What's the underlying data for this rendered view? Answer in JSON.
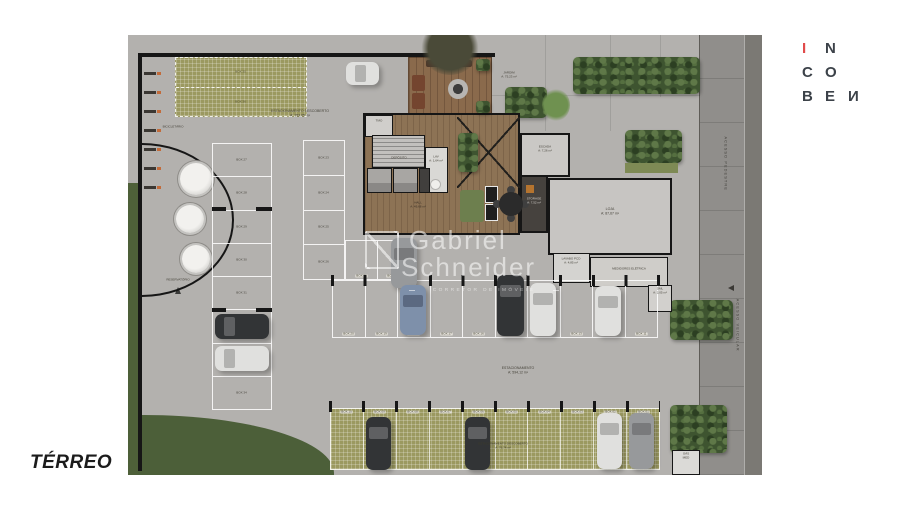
{
  "title": {
    "floor": "TÉRREO"
  },
  "logo": {
    "l1a": "I",
    "l1b": "N",
    "l2a": "C",
    "l2b": "O",
    "l3a": "B",
    "l3b": "E",
    "l3c": "И"
  },
  "watermark": {
    "first": "Gabriel",
    "last": "Schneider",
    "tagline": "CORRETOR DE IMÓVEIS"
  },
  "areas": {
    "bicicletario": "BICICLETÁRIO",
    "estac_desc_top": {
      "name": "ESTACIONAMENTO DESCOBERTO",
      "area": "A: 153,05 m²"
    },
    "reservatorio": "RESERVATÓRIO",
    "jardim": {
      "name": "JARDIM",
      "area": "A: 75,23 m²"
    },
    "tmo": "TMO",
    "deposito": "DEPÓSITO",
    "lav": {
      "name": "LAV",
      "area": "A: 1,64 m²"
    },
    "hall": {
      "name": "HALL",
      "area": "A: 49,68 m²"
    },
    "escada": {
      "name": "ESCADA",
      "area": "A: 7,26 m²"
    },
    "storage": {
      "name": "STORAGE",
      "area": "A: 7,52 m²"
    },
    "loja": {
      "name": "LOJA",
      "area": "A: 87,67 m²"
    },
    "lavabo": {
      "name": "LAVABO PCD",
      "area": "A: 4,85 m²"
    },
    "medidores": "MEDIDORES ELÉTRICA",
    "dml": {
      "name": "DML",
      "area": "A: 2,05 m²"
    },
    "gas": {
      "name": "GÁS",
      "sub": "MED"
    },
    "estacionamento": {
      "name": "ESTACIONAMENTO",
      "area": "A: 594,12 m²"
    },
    "estac_desc_bottom": {
      "name": "ESTACIONAMENTO DESCOBERTO",
      "area": "A: 76,74 m²"
    },
    "acesso_pedestre": "ACESSO PEDESTRE",
    "acesso_veicular": "ACESSO VEICULAR"
  },
  "parking": {
    "grass_boxes": [
      "BOX 35",
      "BOX 36"
    ],
    "left_column": [
      "BOX 27",
      "BOX 28",
      "BOX 29",
      "BOX 30",
      "BOX 31",
      "BOX 32",
      "BOX 33",
      "BOX 34"
    ],
    "side_column": [
      "BOX 23",
      "BOX 24",
      "BOX 25",
      "BOX 26"
    ],
    "upper_row": [
      "BOX 21",
      "BOX 22"
    ],
    "middle_row": [
      "BOX 20",
      "BOX 19",
      "BOX 18",
      "BOX 17",
      "BOX 16",
      "BOX 15",
      "BOX 14",
      "BOX 13",
      "BOX 12",
      "BOX 11"
    ],
    "bottom_row": [
      "BOX 10",
      "BOX 09",
      "BOX 08",
      "BOX 07",
      "BOX 06",
      "BOX 05",
      "BOX 04",
      "BOX 03",
      "BOX 02",
      "BOX 01"
    ]
  },
  "colors": {
    "accent_red": "#e14b4b",
    "paving": "#b3b1ae",
    "sidewalk": "#908e8b",
    "grass": "#4e6039",
    "grass_grid": "#9b9960",
    "wood": "#8d7355",
    "wall": "#161616"
  }
}
